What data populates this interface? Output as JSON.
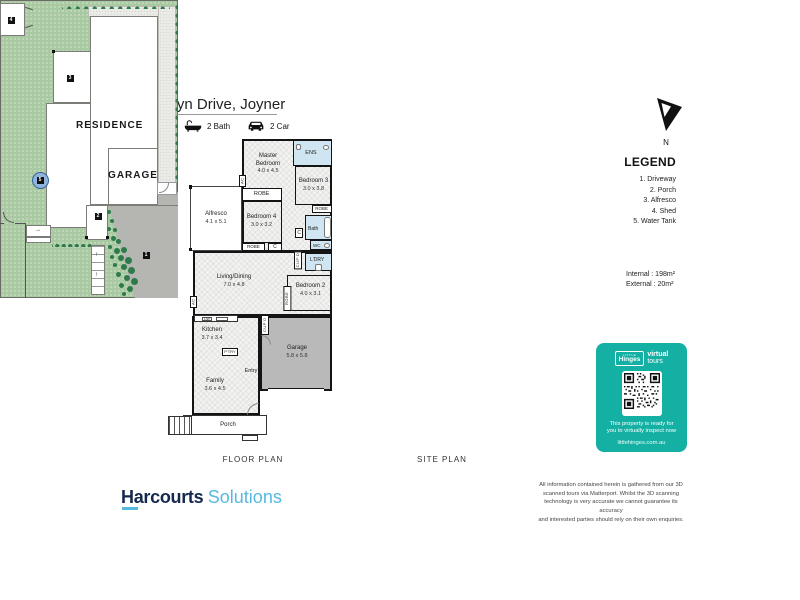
{
  "header": {
    "title": "43 Karelyn Drive, Joyner",
    "features": [
      {
        "icon": "bed-icon",
        "label": "4 Bed"
      },
      {
        "icon": "bath-icon",
        "label": "2 Bath"
      },
      {
        "icon": "car-icon",
        "label": "2 Car"
      }
    ]
  },
  "compass": {
    "label": "N"
  },
  "floor_plan": {
    "caption": "FLOOR PLAN",
    "rooms": {
      "master": {
        "name": "Master Bedroom",
        "dims": "4.0 x 4.5"
      },
      "bedroom3": {
        "name": "Bedroom 3",
        "dims": "3.0 x 3.8"
      },
      "bedroom4": {
        "name": "Bedroom 4",
        "dims": "3.0 x 3.2"
      },
      "bedroom2": {
        "name": "Bedroom 2",
        "dims": "4.0 x 3.1"
      },
      "alfresco": {
        "name": "Alfresco",
        "dims": "4.1 x 5.1"
      },
      "living": {
        "name": "Living/Dining",
        "dims": "7.0 x 4.8"
      },
      "kitchen": {
        "name": "Kitchen",
        "dims": "3.7 x 3.4"
      },
      "family": {
        "name": "Family",
        "dims": "3.6 x 4.5"
      },
      "garage": {
        "name": "Garage",
        "dims": "5.8 x 5.8"
      }
    },
    "small": {
      "robe": "ROBE",
      "c": "C",
      "cupd": "CUP'D",
      "ens": "ENS",
      "bath": "Bath",
      "wc": "WC",
      "ldry": "L'DRY",
      "ptry": "P'TRY",
      "entry": "Entry",
      "porch": "Porch",
      "ac": "AC",
      "dw": "DW"
    }
  },
  "site_plan": {
    "caption": "SITE PLAN",
    "residence_label": "RESIDENCE",
    "garage_label": "GARAGE",
    "markers": [
      "1",
      "2",
      "3",
      "4",
      "5"
    ]
  },
  "legend": {
    "title": "LEGEND",
    "items": [
      "1. Driveway",
      "2. Porch",
      "3. Alfresco",
      "4. Shed",
      "5. Water Tank"
    ],
    "internal": "Internal : 198m²",
    "external": "External :  20m²"
  },
  "badge": {
    "brand_small": "LITTLE",
    "brand": "Hinges",
    "product_line1": "virtual",
    "product_line2": "tours",
    "message_line1": "This property is ready for",
    "message_line2": "you to virtually inspect now",
    "url": "littlehinges.com.au",
    "color": "#14b0a4"
  },
  "footer": {
    "brand": "Harcourts",
    "brand2": "Solutions",
    "disclaimer": [
      "All information contained herein is gathered from our 3D",
      "scanned tours via Matterport. Whilst the 3D scanning",
      "technology is very accurate we cannot guarantee its accuracy",
      "and interested parties should rely on their own enquiries."
    ]
  },
  "colors": {
    "teal": "#14b0a4",
    "lawn": "#a8c9a1",
    "hedge": "#2f7a4b",
    "driveway": "#b5b5b2",
    "wet_area": "#cfe5f1",
    "navy": "#15294f",
    "lightblue": "#57b9de"
  }
}
